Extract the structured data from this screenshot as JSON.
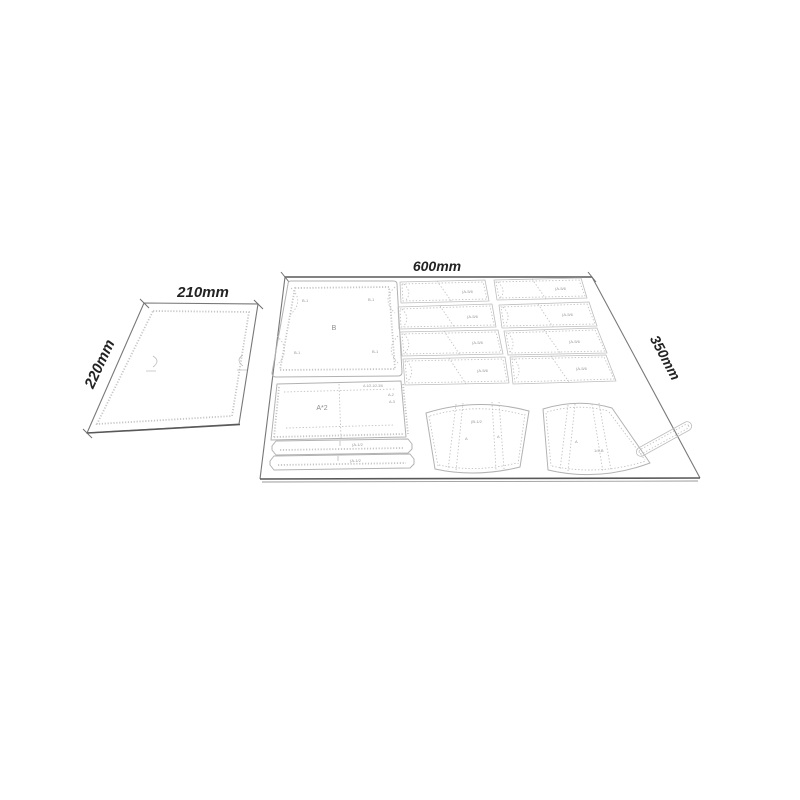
{
  "colors": {
    "background": "#ffffff",
    "sheet_edge": "#787878",
    "sheet_edge_dark": "#585858",
    "piece_outline": "#b2b2b2",
    "stitch_line": "#c6c6c6",
    "dimension_text": "#232323",
    "tiny_text": "#979797"
  },
  "small_sheet": {
    "width_label": "210mm",
    "height_label": "220mm"
  },
  "large_sheet": {
    "width_label": "600mm",
    "height_label": "350mm",
    "flap": {
      "label": "B",
      "corner_1": "B-1",
      "corner_2": "B-1",
      "corner_3": "B-1",
      "corner_4": "B-1"
    },
    "body": {
      "label": "A*2",
      "note_top": "A-1/2-1/2-3/6",
      "note_a2": "A-2",
      "note_a3": "A-3"
    },
    "strips": [
      {
        "label": "(A-1/2"
      },
      {
        "label": "(A-1/2"
      }
    ],
    "cards": [
      {
        "label": "(A-5/6"
      },
      {
        "label": "(A-5/6"
      },
      {
        "label": "(A-5/6"
      },
      {
        "label": "(A-5/6"
      },
      {
        "label": "(A-5/6"
      },
      {
        "label": "(A-5/6"
      },
      {
        "label": "(A-5/6"
      },
      {
        "label": "(A-5/6"
      }
    ],
    "fans": [
      {
        "label": "(B-1/2",
        "mark_left": "A",
        "mark_right": "A"
      },
      {
        "label": "1/4-B",
        "mark_left": "A"
      }
    ]
  }
}
